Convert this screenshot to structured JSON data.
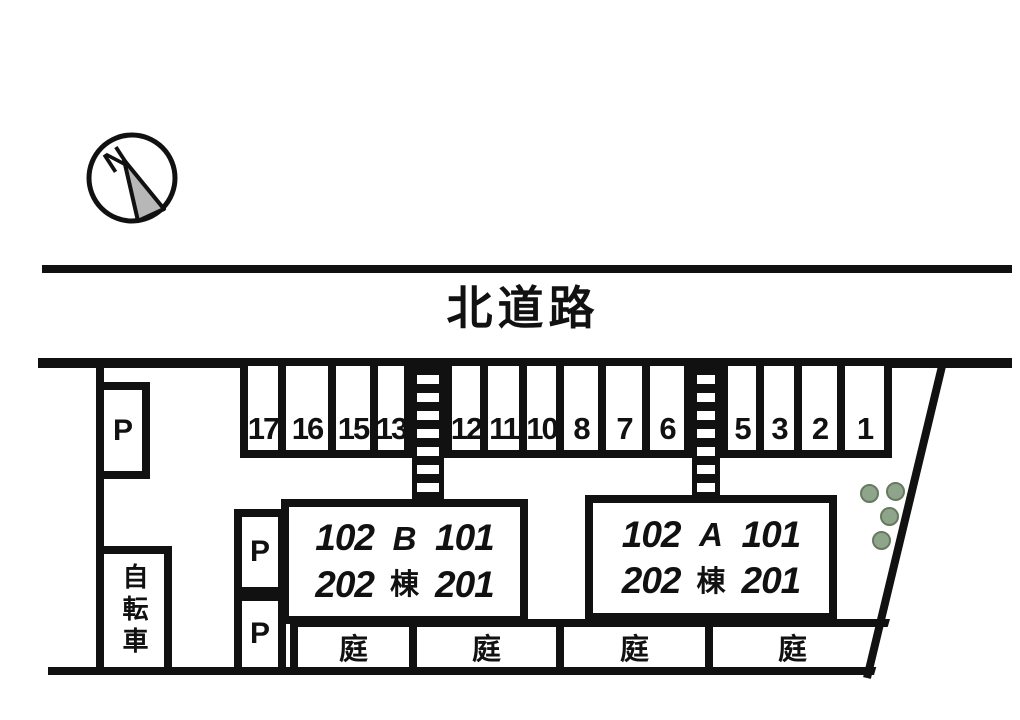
{
  "compass": {
    "label": "N"
  },
  "road": {
    "label": "北道路"
  },
  "parking": {
    "spaces": [
      "17",
      "16",
      "15",
      "13",
      "12",
      "11",
      "10",
      "8",
      "7",
      "6",
      "5",
      "3",
      "2",
      "1"
    ]
  },
  "lots": {
    "p_left": "P",
    "p_mid1": "P",
    "p_mid2": "P"
  },
  "bicycle": {
    "label": "自転車"
  },
  "buildings": {
    "b": {
      "letter": "B",
      "suffix": "棟",
      "unit_tl": "102",
      "unit_tr": "101",
      "unit_bl": "202",
      "unit_br": "201"
    },
    "a": {
      "letter": "A",
      "suffix": "棟",
      "unit_tl": "102",
      "unit_tr": "101",
      "unit_bl": "202",
      "unit_br": "201"
    }
  },
  "gardens": {
    "g1": "庭",
    "g2": "庭",
    "g3": "庭",
    "g4": "庭"
  },
  "colors": {
    "line": "#111111",
    "tree_fill": "#8ea58c",
    "tree_stroke": "#67795f",
    "compass_arrow_fill": "#b7b7b7"
  }
}
